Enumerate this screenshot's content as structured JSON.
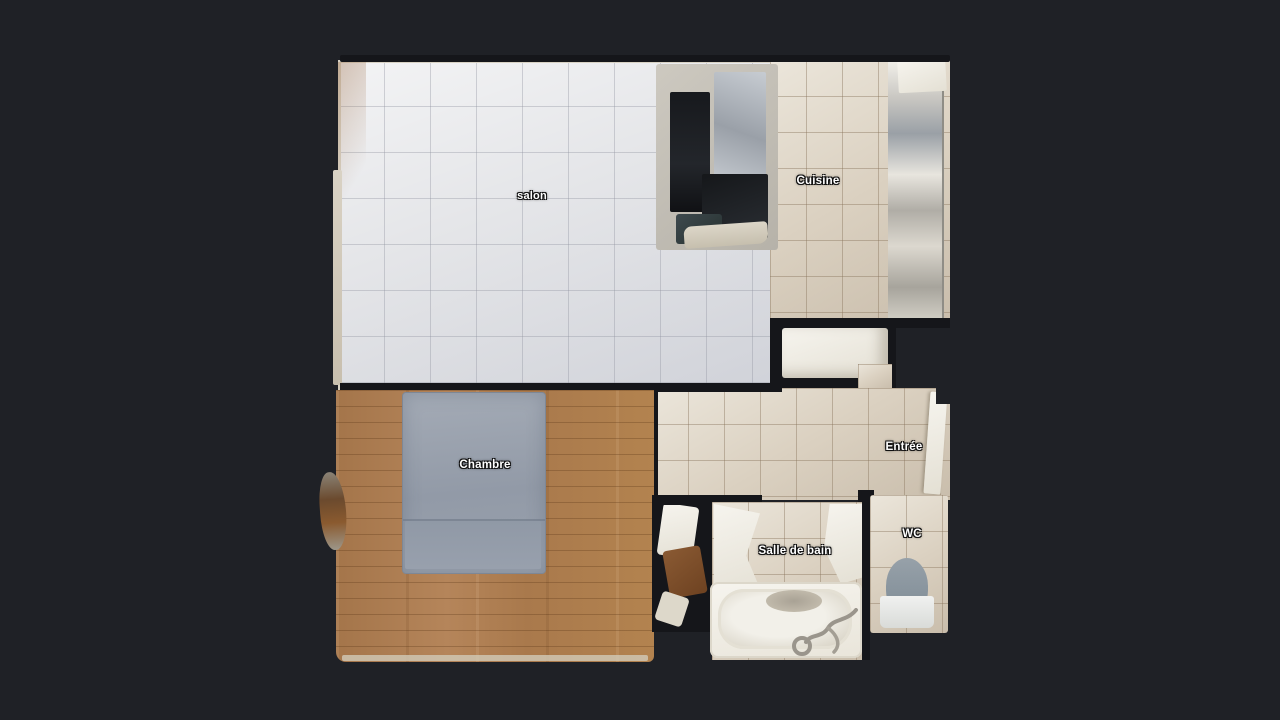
{
  "viewer": {
    "background_color": "#1f2126",
    "wall_color": "#15161a"
  },
  "floorplan": {
    "view": "top-down textured 3D scan floor plan",
    "rooms": [
      {
        "id": "salon",
        "label": "salon"
      },
      {
        "id": "cuisine",
        "label": "Cuisine"
      },
      {
        "id": "chambre",
        "label": "Chambre"
      },
      {
        "id": "entree",
        "label": "Entrée"
      },
      {
        "id": "salle-de-bain",
        "label": "Salle de bain"
      },
      {
        "id": "wc",
        "label": "WC"
      }
    ],
    "colors": {
      "salon_tile": "#e4e5e8",
      "warm_tile": "#dbd1c1",
      "wood_floor": "#ac7c4f",
      "bed": "#98a0ac",
      "fixture_white": "#f2efe8",
      "toilet_seat": "#8d98a2"
    }
  }
}
